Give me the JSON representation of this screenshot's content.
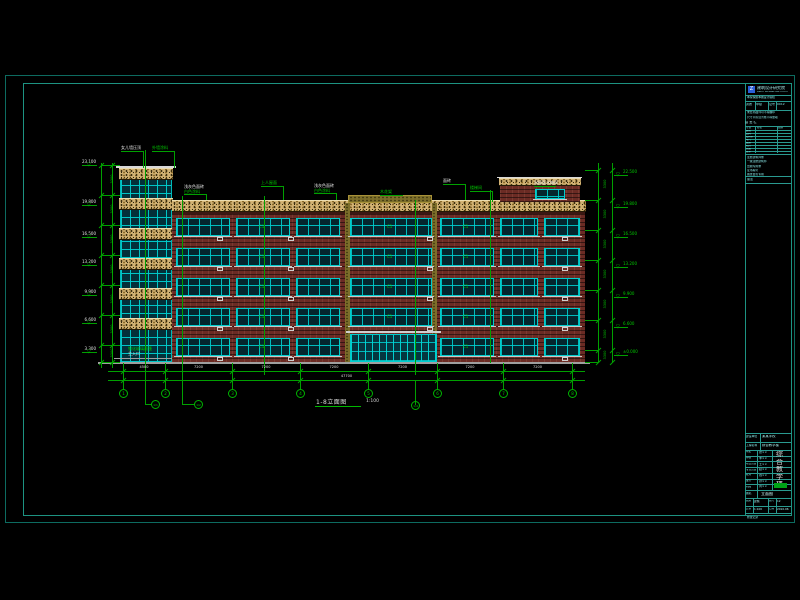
{
  "colors": {
    "background": "#000000",
    "border_outer": "#0d6b60",
    "border_inner": "#1d9382",
    "annotation_green": "#00c800",
    "dimension_green": "#00a000",
    "window_cyan": "#00cdcd",
    "brick_red": "#6b2b24",
    "stone_band_tan": "#d2b273",
    "text_white": "#e4e4e4",
    "titleblock_cyan": "#8ae8e8",
    "logo_blue": "#2b5fd9",
    "approved_cell_green": "#00a316"
  },
  "drawing": {
    "title": "1-8立面图",
    "scale": "1:100",
    "overall_dim": "47700",
    "bottom_dims": [
      "4500",
      "7200",
      "7200",
      "7200",
      "7200",
      "7200",
      "7200"
    ],
    "grid_labels": [
      "1",
      "2",
      "3",
      "4",
      "5",
      "6",
      "7",
      "8"
    ],
    "sub_grid_labels": [
      "1/1",
      "1/2",
      "1/4"
    ],
    "left_elevations": [
      "23.100",
      "19.800",
      "16.500",
      "13.200",
      "9.900",
      "6.600",
      "3.300"
    ],
    "right_elevations": [
      "22.500",
      "19.800",
      "16.500",
      "13.200",
      "9.900",
      "6.600",
      "±0.000"
    ],
    "floor_dim": "3300",
    "window_tag": "C1",
    "roof_labels": [
      {
        "l1": "女儿墙压顶",
        "c1": "w"
      },
      {
        "l1": "外墙涂料",
        "c1": "g"
      },
      {
        "l1": "浅灰色面砖",
        "l2": "白色涂料",
        "c1": "w",
        "c2": "g"
      },
      {
        "l1": "上人屋面",
        "c1": "g"
      },
      {
        "l1": "浅灰色面砖",
        "l2": "白色涂料",
        "c1": "w",
        "c2": "g"
      },
      {
        "l1": "木花架",
        "c1": "g"
      },
      {
        "l1": "面砖",
        "c1": "w"
      },
      {
        "l1": "楼梯间",
        "c1": "g"
      },
      {
        "l1": "出屋面水箱间",
        "c1": "w"
      }
    ],
    "entrance_label_1": "钢化玻璃雨篷",
    "entrance_label_2": "主入口"
  },
  "titleblock": {
    "logo_text": "建筑设计研究院",
    "logo_sub": "ARCH DESIGN INSTITUTE",
    "cert_cells": [
      "资质",
      "甲级",
      "证号",
      "0012"
    ],
    "note_lines": [
      "本院保留本图设计版权",
      "未经书面许可不得翻印",
      "尺寸以标注为准不得量取"
    ],
    "sign_title": "会 签 栏",
    "sign_cols": [
      "专业",
      "签名",
      "日期"
    ],
    "sign_rows": [
      "建筑",
      "结构",
      "给排水",
      "电气",
      "暖通",
      "动力",
      "总图",
      "技术"
    ],
    "stamp_lines": [
      "注册建筑师章",
      "一级注册建筑师",
      "出图专用章",
      "证书编号",
      "图纸会签专用"
    ],
    "extra_label": "备注",
    "owner_label": "建设单位",
    "owner_value": "某某学校",
    "project_label": "工程名称",
    "project_value": "综合教学楼",
    "staff_rows": [
      [
        "审定",
        "张××"
      ],
      [
        "审核",
        "李××"
      ],
      [
        "项目负责",
        "王××"
      ],
      [
        "专业负责",
        "赵××"
      ],
      [
        "校对",
        "钱××"
      ],
      [
        "设计",
        "孙××"
      ],
      [
        "制图",
        "周××"
      ]
    ],
    "project_vertical": [
      "综",
      "合",
      "教",
      "学",
      "楼"
    ],
    "drawing_name_label": "图名",
    "drawing_name_value": "立面图",
    "meta_cells": [
      [
        {
          "l": "图别",
          "v": "建施"
        },
        {
          "l": "图号",
          "v": "12"
        }
      ],
      [
        {
          "l": "比例",
          "v": "1:100"
        },
        {
          "l": "日期",
          "v": "2010.06"
        }
      ]
    ],
    "footer_note": "修改记录"
  }
}
